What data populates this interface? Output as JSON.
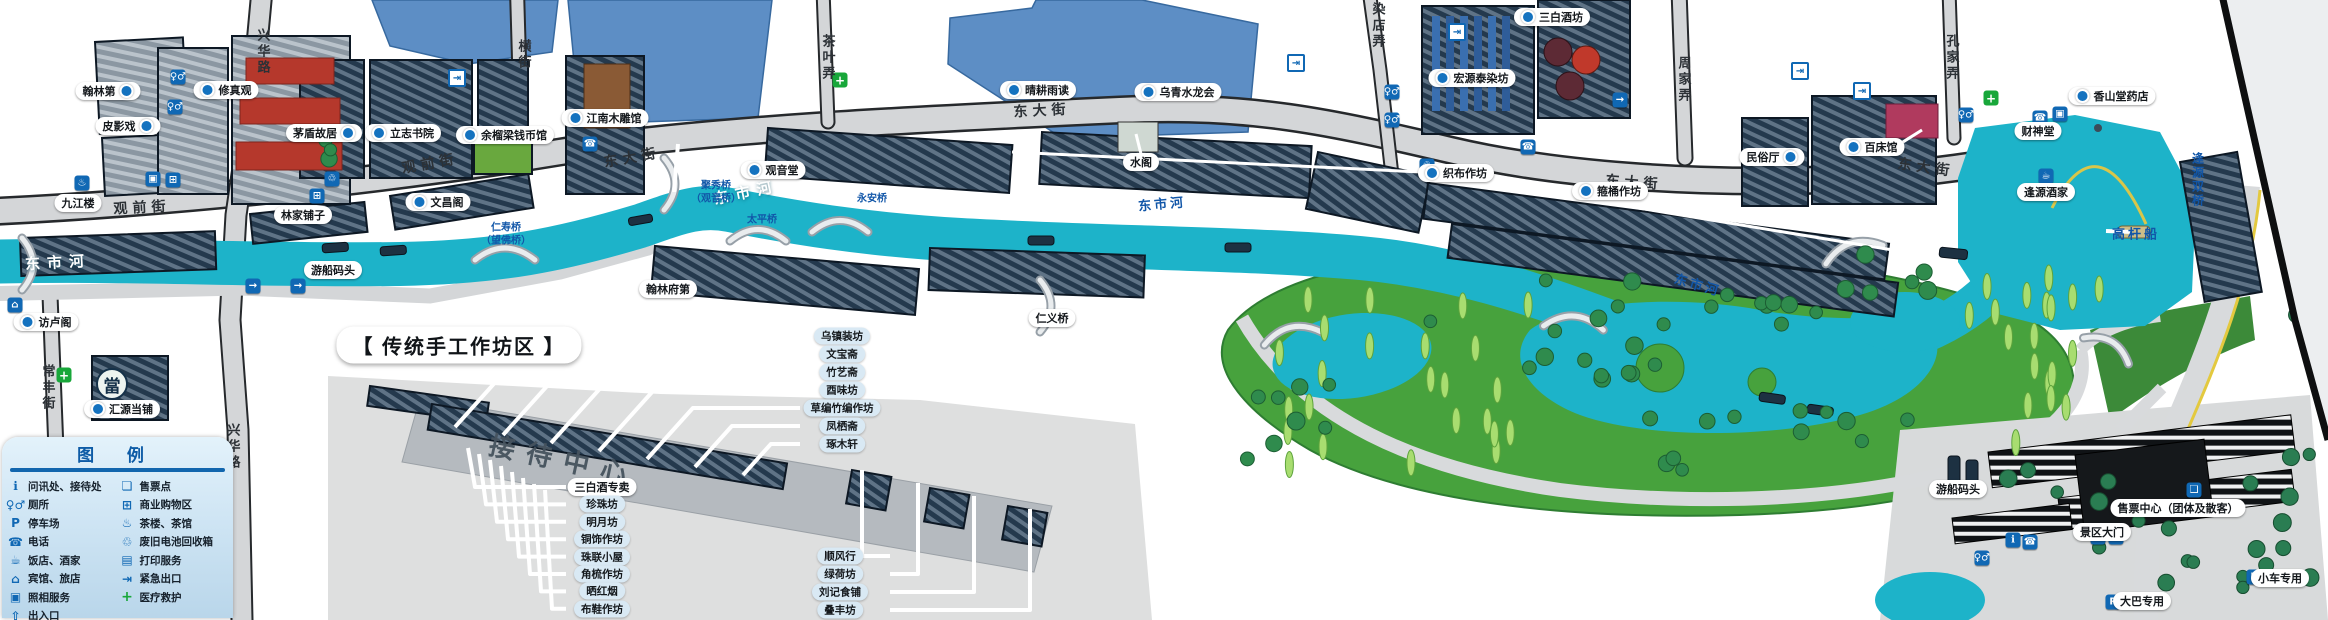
{
  "map": {
    "colors": {
      "water_canal": "#1db3c9",
      "water_lake": "#5d8ec5",
      "building_navy": "#24394d",
      "street_gray": "#d4d6d8",
      "park_green": "#47a23d",
      "accent_blue": "#1068b4",
      "legend_bg": "#cfe5f4",
      "legend_title": "#0d5ba6",
      "label_blue_text": "#1156a8"
    },
    "legend": {
      "title": "图  例",
      "left": [
        {
          "icon": "info",
          "label": "问讯处、接待处"
        },
        {
          "icon": "toilet",
          "label": "厕所"
        },
        {
          "icon": "parking",
          "label": "停车场"
        },
        {
          "icon": "phone",
          "label": "电话"
        },
        {
          "icon": "restaurant",
          "label": "饭店、酒家"
        },
        {
          "icon": "hotel",
          "label": "宾馆、旅店"
        },
        {
          "icon": "photo",
          "label": "照相服务"
        },
        {
          "icon": "entrance",
          "label": "出入口"
        }
      ],
      "right": [
        {
          "icon": "ticket",
          "label": "售票点"
        },
        {
          "icon": "shopping",
          "label": "商业购物区"
        },
        {
          "icon": "teahouse",
          "label": "茶楼、茶馆"
        },
        {
          "icon": "battery",
          "label": "废旧电池回收箱"
        },
        {
          "icon": "printing",
          "label": "打印服务"
        },
        {
          "icon": "emergency",
          "label": "紧急出口"
        },
        {
          "icon": "medical",
          "label": "医疗救护"
        }
      ]
    },
    "workshops": {
      "title": "【  传统手工作坊区  】",
      "reception": "接待中心",
      "left_column": [
        "三白酒专卖",
        "珍珠坊",
        "明月坊",
        "铜饰作坊",
        "珠联小屋",
        "角梳作坊",
        "晒红烟",
        "布鞋作坊"
      ],
      "right_column": [
        "乌镇装坊",
        "文宝斋",
        "竹艺斋",
        "酉味坊",
        "草编竹编作坊",
        "凤栖斋",
        "琢木轩"
      ],
      "bottom_column": [
        "顺风行",
        "绿荷坊",
        "刘记食铺",
        "叠丰坊"
      ]
    },
    "labels": [
      {
        "t": "常丰街",
        "x": 48,
        "y": 388,
        "k": "stv"
      },
      {
        "t": "观前街",
        "x": 142,
        "y": 207,
        "k": "st",
        "r": -3
      },
      {
        "t": "观前街",
        "x": 430,
        "y": 163,
        "k": "st",
        "r": -10
      },
      {
        "t": "兴华路",
        "x": 263,
        "y": 52,
        "k": "stv"
      },
      {
        "t": "兴华路",
        "x": 233,
        "y": 447,
        "k": "stv"
      },
      {
        "t": "横街",
        "x": 524,
        "y": 55,
        "k": "stv"
      },
      {
        "t": "茶叶弄",
        "x": 828,
        "y": 58,
        "k": "stv"
      },
      {
        "t": "染店弄",
        "x": 1378,
        "y": 26,
        "k": "stv"
      },
      {
        "t": "周家弄",
        "x": 1684,
        "y": 80,
        "k": "stv"
      },
      {
        "t": "孔家弄",
        "x": 1952,
        "y": 58,
        "k": "stv"
      },
      {
        "t": "东大街",
        "x": 632,
        "y": 157,
        "k": "st",
        "r": -10
      },
      {
        "t": "东大街",
        "x": 1042,
        "y": 110,
        "k": "st",
        "r": -3
      },
      {
        "t": "东大街",
        "x": 1634,
        "y": 182,
        "k": "st",
        "r": 4
      },
      {
        "t": "东大街",
        "x": 1926,
        "y": 167,
        "k": "st",
        "r": 8
      },
      {
        "t": "东市河",
        "x": 58,
        "y": 262,
        "k": "rw",
        "r": -3
      },
      {
        "t": "东市河",
        "x": 746,
        "y": 192,
        "k": "rw",
        "r": -12
      },
      {
        "t": "东市河",
        "x": 1162,
        "y": 203,
        "k": "rb2",
        "r": -5
      },
      {
        "t": "东市河",
        "x": 1698,
        "y": 284,
        "k": "rb2",
        "r": 16
      },
      {
        "t": "仁寿桥",
        "x": 506,
        "y": 226,
        "k": "rb"
      },
      {
        "t": "（望佛桥）",
        "x": 506,
        "y": 239,
        "k": "rb"
      },
      {
        "t": "聚秀桥",
        "x": 716,
        "y": 184,
        "k": "rb"
      },
      {
        "t": "（观音桥）",
        "x": 716,
        "y": 197,
        "k": "rb"
      },
      {
        "t": "太平桥",
        "x": 762,
        "y": 218,
        "k": "rb"
      },
      {
        "t": "永安桥",
        "x": 872,
        "y": 197,
        "k": "rb"
      },
      {
        "t": "仁义桥",
        "x": 1052,
        "y": 318,
        "k": "p"
      },
      {
        "t": "高杆船",
        "x": 2136,
        "y": 233,
        "k": "rb2"
      },
      {
        "t": "逢源双桥",
        "x": 2198,
        "y": 180,
        "k": "rbv"
      },
      {
        "t": "访卢阁",
        "x": 46,
        "y": 322,
        "k": "p",
        "d": "l"
      },
      {
        "t": "汇源当铺",
        "x": 122,
        "y": 409,
        "k": "p",
        "d": "l"
      },
      {
        "t": "九江楼",
        "x": 78,
        "y": 203,
        "k": "p"
      },
      {
        "t": "翰林第",
        "x": 108,
        "y": 91,
        "k": "p",
        "d": "r"
      },
      {
        "t": "皮影戏",
        "x": 128,
        "y": 126,
        "k": "p",
        "d": "r"
      },
      {
        "t": "修真观",
        "x": 226,
        "y": 90,
        "k": "p",
        "d": "l"
      },
      {
        "t": "茅盾故居",
        "x": 324,
        "y": 133,
        "k": "p",
        "d": "r"
      },
      {
        "t": "立志书院",
        "x": 403,
        "y": 133,
        "k": "p",
        "d": "l"
      },
      {
        "t": "余榴梁钱币馆",
        "x": 505,
        "y": 135,
        "k": "p",
        "d": "l"
      },
      {
        "t": "文昌阁",
        "x": 438,
        "y": 202,
        "k": "p",
        "d": "l"
      },
      {
        "t": "林家铺子",
        "x": 303,
        "y": 215,
        "k": "p"
      },
      {
        "t": "江南木雕馆",
        "x": 605,
        "y": 118,
        "k": "p",
        "d": "l"
      },
      {
        "t": "观音堂",
        "x": 773,
        "y": 170,
        "k": "p",
        "d": "l"
      },
      {
        "t": "水阁",
        "x": 1141,
        "y": 162,
        "k": "p"
      },
      {
        "t": "晴耕雨读",
        "x": 1038,
        "y": 90,
        "k": "p",
        "d": "l"
      },
      {
        "t": "乌青水龙会",
        "x": 1178,
        "y": 92,
        "k": "p",
        "d": "l"
      },
      {
        "t": "宏源泰染坊",
        "x": 1472,
        "y": 78,
        "k": "p",
        "d": "l"
      },
      {
        "t": "三白酒坊",
        "x": 1552,
        "y": 17,
        "k": "p",
        "d": "l"
      },
      {
        "t": "织布作坊",
        "x": 1456,
        "y": 173,
        "k": "p",
        "d": "l"
      },
      {
        "t": "箍桶作坊",
        "x": 1610,
        "y": 191,
        "k": "p",
        "d": "l"
      },
      {
        "t": "民俗厅",
        "x": 1772,
        "y": 157,
        "k": "p",
        "d": "r"
      },
      {
        "t": "百床馆",
        "x": 1872,
        "y": 147,
        "k": "p",
        "d": "l"
      },
      {
        "t": "财神堂",
        "x": 2038,
        "y": 131,
        "k": "p"
      },
      {
        "t": "香山堂药店",
        "x": 2112,
        "y": 96,
        "k": "p",
        "d": "l"
      },
      {
        "t": "逢源酒家",
        "x": 2046,
        "y": 192,
        "k": "p"
      },
      {
        "t": "游船码头",
        "x": 333,
        "y": 270,
        "k": "p"
      },
      {
        "t": "游船码头",
        "x": 1958,
        "y": 489,
        "k": "p"
      },
      {
        "t": "翰林府第",
        "x": 668,
        "y": 289,
        "k": "p"
      },
      {
        "t": "景区大门",
        "x": 2102,
        "y": 532,
        "k": "p"
      },
      {
        "t": "售票中心（团体及散客）",
        "x": 2178,
        "y": 508,
        "k": "p"
      },
      {
        "t": "大巴专用",
        "x": 2142,
        "y": 601,
        "k": "p"
      },
      {
        "t": "小车专用",
        "x": 2280,
        "y": 578,
        "k": "p"
      }
    ],
    "icon_glyphs": {
      "info": "ℹ",
      "toilet": "♀♂",
      "parking": "P",
      "phone": "☎",
      "restaurant": "☕",
      "hotel": "⌂",
      "photo": "▣",
      "entrance": "⇧",
      "ticket": "❏",
      "shopping": "⊞",
      "teahouse": "♨",
      "battery": "♲",
      "printing": "▤",
      "emergency": "⇥",
      "medical": "+",
      "pawnshop": "當",
      "exit_arrow": "→"
    },
    "map_icons": [
      {
        "g": "toilet",
        "x": 178,
        "y": 77,
        "c": "bluesq"
      },
      {
        "g": "toilet",
        "x": 175,
        "y": 107,
        "c": "bluesq"
      },
      {
        "g": "toilet",
        "x": 1392,
        "y": 92,
        "c": "bluesq"
      },
      {
        "g": "toilet",
        "x": 1392,
        "y": 120,
        "c": "bluesq"
      },
      {
        "g": "toilet",
        "x": 1966,
        "y": 115,
        "c": "bluesq"
      },
      {
        "g": "toilet",
        "x": 1982,
        "y": 558,
        "c": "bluesq"
      },
      {
        "g": "phone",
        "x": 590,
        "y": 144,
        "c": "bluesq"
      },
      {
        "g": "phone",
        "x": 1528,
        "y": 147,
        "c": "bluesq"
      },
      {
        "g": "phone",
        "x": 2040,
        "y": 118,
        "c": "bluesq"
      },
      {
        "g": "phone",
        "x": 2030,
        "y": 542,
        "c": "bluesq"
      },
      {
        "g": "photo",
        "x": 153,
        "y": 179,
        "c": "bluesq"
      },
      {
        "g": "photo",
        "x": 2060,
        "y": 114,
        "c": "bluesq"
      },
      {
        "g": "shopping",
        "x": 173,
        "y": 180,
        "c": "bluesq"
      },
      {
        "g": "shopping",
        "x": 317,
        "y": 196,
        "c": "bluesq"
      },
      {
        "g": "teahouse",
        "x": 82,
        "y": 183,
        "c": "bluesq"
      },
      {
        "g": "restaurant",
        "x": 2046,
        "y": 176,
        "c": "bluesq"
      },
      {
        "g": "medical",
        "x": 64,
        "y": 375,
        "c": "greensq"
      },
      {
        "g": "medical",
        "x": 840,
        "y": 80,
        "c": "greensq"
      },
      {
        "g": "medical",
        "x": 1991,
        "y": 98,
        "c": "greensq"
      },
      {
        "g": "battery",
        "x": 332,
        "y": 179,
        "c": "bluesq"
      },
      {
        "g": "battery",
        "x": 1427,
        "y": 166,
        "c": "bluesq"
      },
      {
        "g": "exit_arrow",
        "x": 253,
        "y": 286,
        "c": "bluesq"
      },
      {
        "g": "exit_arrow",
        "x": 298,
        "y": 286,
        "c": "bluesq"
      },
      {
        "g": "exit_arrow",
        "x": 2098,
        "y": 537,
        "c": "bluesq"
      },
      {
        "g": "exit_arrow",
        "x": 2116,
        "y": 537,
        "c": "bluesq"
      },
      {
        "g": "exit_arrow",
        "x": 1620,
        "y": 100,
        "c": "bluesq"
      },
      {
        "g": "emergency",
        "x": 457,
        "y": 78,
        "c": "whitesq"
      },
      {
        "g": "emergency",
        "x": 1296,
        "y": 63,
        "c": "whitesq"
      },
      {
        "g": "emergency",
        "x": 1457,
        "y": 32,
        "c": "whitesq"
      },
      {
        "g": "emergency",
        "x": 1800,
        "y": 71,
        "c": "whitesq"
      },
      {
        "g": "emergency",
        "x": 1862,
        "y": 91,
        "c": "whitesq"
      },
      {
        "g": "info",
        "x": 2013,
        "y": 540,
        "c": "bluesq"
      },
      {
        "g": "ticket",
        "x": 2194,
        "y": 490,
        "c": "bluesq"
      },
      {
        "g": "parking",
        "x": 2254,
        "y": 577,
        "c": "bluesq"
      },
      {
        "g": "parking",
        "x": 2113,
        "y": 602,
        "c": "bluesq"
      },
      {
        "g": "hotel",
        "x": 15,
        "y": 305,
        "c": "bluesq"
      },
      {
        "g": "pawnshop",
        "x": 112,
        "y": 384,
        "c": "pawn"
      }
    ]
  }
}
